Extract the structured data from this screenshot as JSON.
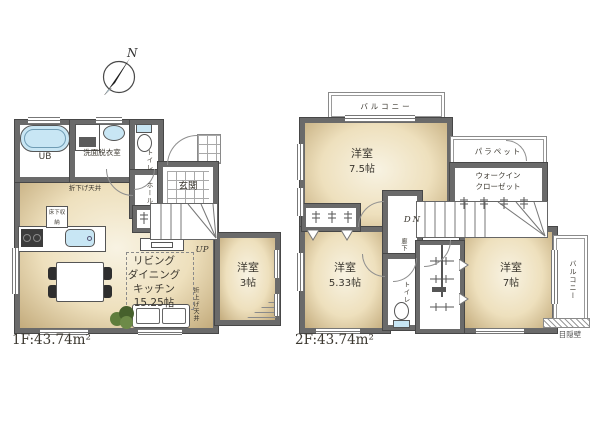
{
  "compass": {
    "north_label": "N"
  },
  "floor1": {
    "area_label": "1F:43.74m²",
    "bath_label": "UB",
    "washroom_label": "洗面脱衣室",
    "toilet_label": "トイレ",
    "hall_label": "ホール",
    "entrance_label": "玄関",
    "dropped_ceiling_label": "折下げ天井",
    "floor_storage_label": "床下収納",
    "ldk_lines": [
      "リビング",
      "ダイニング",
      "キッチン",
      "15.25帖"
    ],
    "raised_ceiling_label": "折上げ天井",
    "stairs_up_label": "UP",
    "western_room_3": {
      "name": "洋室",
      "size": "3帖"
    }
  },
  "floor2": {
    "area_label": "2F:43.74m²",
    "balcony_top_label": "バルコニー",
    "parapet_label": "パラペット",
    "walk_in_closet_lines": [
      "ウォークイン",
      "クローゼット"
    ],
    "western_room_7_5": {
      "name": "洋室",
      "size": "7.5帖"
    },
    "stairs_down_label": "DN",
    "corridor_label": "廊下",
    "western_room_5_33": {
      "name": "洋室",
      "size": "5.33帖"
    },
    "toilet_label": "トイレ",
    "western_room_7": {
      "name": "洋室",
      "size": "7帖"
    },
    "balcony_right_label": "バルコニー",
    "privacy_wall_label": "目隠壁"
  },
  "colors": {
    "wall": "#6a6a6a",
    "room_fill_center": "#f8f3e3",
    "room_fill_edge": "#c3ab7c",
    "fixture_blue": "#c8e6f4",
    "plant_green": "#5f7d3c"
  }
}
